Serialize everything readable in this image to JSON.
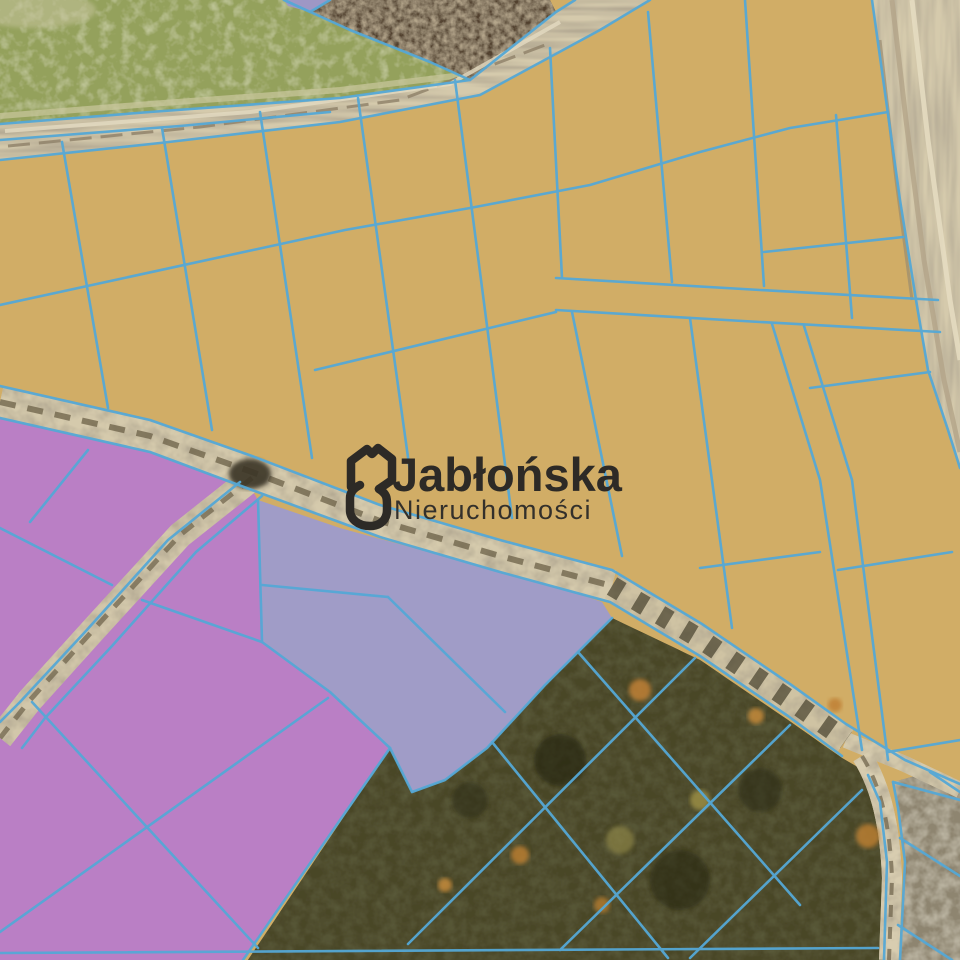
{
  "branding": {
    "name": "Jabłońska",
    "subtitle": "Nieruchomości",
    "logo_color": "#2d2a26"
  },
  "map": {
    "type": "aerial-parcel-map",
    "parcel_line_color": "#55a8d6",
    "zones": [
      {
        "id": "offer-parcels-tan",
        "color": "#d1ad66"
      },
      {
        "id": "offer-parcels-magenta",
        "color": "#ba7fc5"
      },
      {
        "id": "offer-parcels-lavender",
        "color": "#a09cc7"
      },
      {
        "id": "forest-parcels-unshaded",
        "color": "#4a4728"
      },
      {
        "id": "green-field",
        "color": "#94a15b"
      },
      {
        "id": "ploughed-patch",
        "color": "#51402d"
      },
      {
        "id": "fallow-field",
        "color": "#8e8570"
      },
      {
        "id": "dirt-roads",
        "color": "#d5caac"
      }
    ]
  }
}
